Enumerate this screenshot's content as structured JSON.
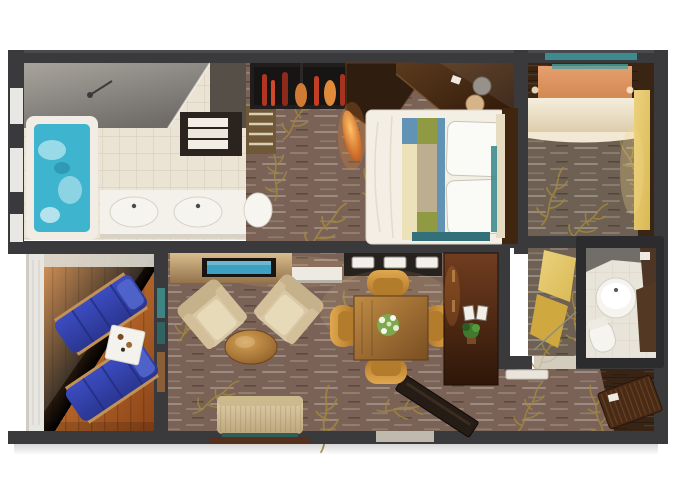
{
  "image": {
    "type": "floorplan-rendering",
    "subject": "top-down 3D rendered floor plan of a two-bedroom suite with balcony",
    "width_px": 680,
    "height_px": 486
  },
  "palette": {
    "background": "#ffffff",
    "wall": "#3a393c",
    "wall_highlight": "#4a494d",
    "carpet_main": "#7a6356",
    "carpet_right": "#6e6153",
    "carpet_streak": "#cdb89c",
    "vine_gold": "#a3883f",
    "tile": "#ebe3d4",
    "tile_line": "#d5cabb",
    "shower_gray": "#8d8a85",
    "tub_water": "#3fb4cf",
    "tub_foam": "#bfe9f2",
    "deck_orange": "#d6873f",
    "deck_dark": "#8c4418",
    "rail_white": "#e8e6e1",
    "lounger_blue": "#3b4cc0",
    "lounger_dark": "#2b3691",
    "bed_white": "#f3efe5",
    "runner_blue": "#6292b4",
    "runner_olive": "#8f9a42",
    "runner_cream": "#ece1b8",
    "runner_taupe": "#bcae8f",
    "teal_accent": "#3e8b8f",
    "armchair_beige": "#d9c8a6",
    "sofa_beige": "#d6c49c",
    "table_wood": "#c08c45",
    "chair_gold": "#d89b3c",
    "console_tan": "#c9a97a",
    "tv_screen": "#3f9fc0",
    "cabinet_dark_red": "#572e1b",
    "door_gold": "#d9b954",
    "cream_cabinet": "#ede2cb",
    "peach_bed": "#e59f6e",
    "wood_dark": "#3a2413",
    "vase_red": "#b03522",
    "sink_white": "#f6f4ef",
    "plant_green": "#3f7a2e"
  },
  "rooms": [
    {
      "name": "master-bathroom",
      "floor": "cream tile",
      "position": "top-left"
    },
    {
      "name": "dressing-area",
      "floor": "carpet",
      "position": "top-center-left"
    },
    {
      "name": "master-bedroom",
      "floor": "carpet",
      "position": "top-center-right"
    },
    {
      "name": "second-bedroom",
      "floor": "wood and carpet",
      "position": "top-right"
    },
    {
      "name": "guest-bathroom",
      "floor": "tile",
      "position": "right"
    },
    {
      "name": "balcony",
      "floor": "orange wood deck",
      "position": "left"
    },
    {
      "name": "living-room",
      "floor": "carpet",
      "position": "center"
    },
    {
      "name": "dining-area",
      "floor": "carpet",
      "position": "center-right"
    },
    {
      "name": "entry-hall",
      "floor": "carpet and wood",
      "position": "bottom-right"
    }
  ],
  "furniture": [
    "shower",
    "bathtub-with-water",
    "double-vanity-sinks",
    "toilet",
    "towel-counter",
    "slatted-bench",
    "display-shelf-with-red-vases",
    "angled-wardrobe",
    "orange-vase",
    "vanity-desk-with-stools",
    "king-bed-with-striped-runner",
    "pillows",
    "headboard",
    "cream-wardrobe",
    "peach-bed",
    "mirror-panel",
    "round-sink",
    "guest-toilet",
    "gold-folding-door",
    "lounge-chair",
    "lounge-chair",
    "balcony-side-table",
    "tv-console",
    "flat-tv-screen",
    "armchair",
    "armchair",
    "oval-coffee-table",
    "sofa",
    "dining-table-with-flowers",
    "dining-chair",
    "dining-chair",
    "dining-chair",
    "dining-chair",
    "sideboard-with-plates",
    "tall-cabinet-with-frames-and-plant",
    "entry-door",
    "hall-console",
    "door-mat"
  ]
}
